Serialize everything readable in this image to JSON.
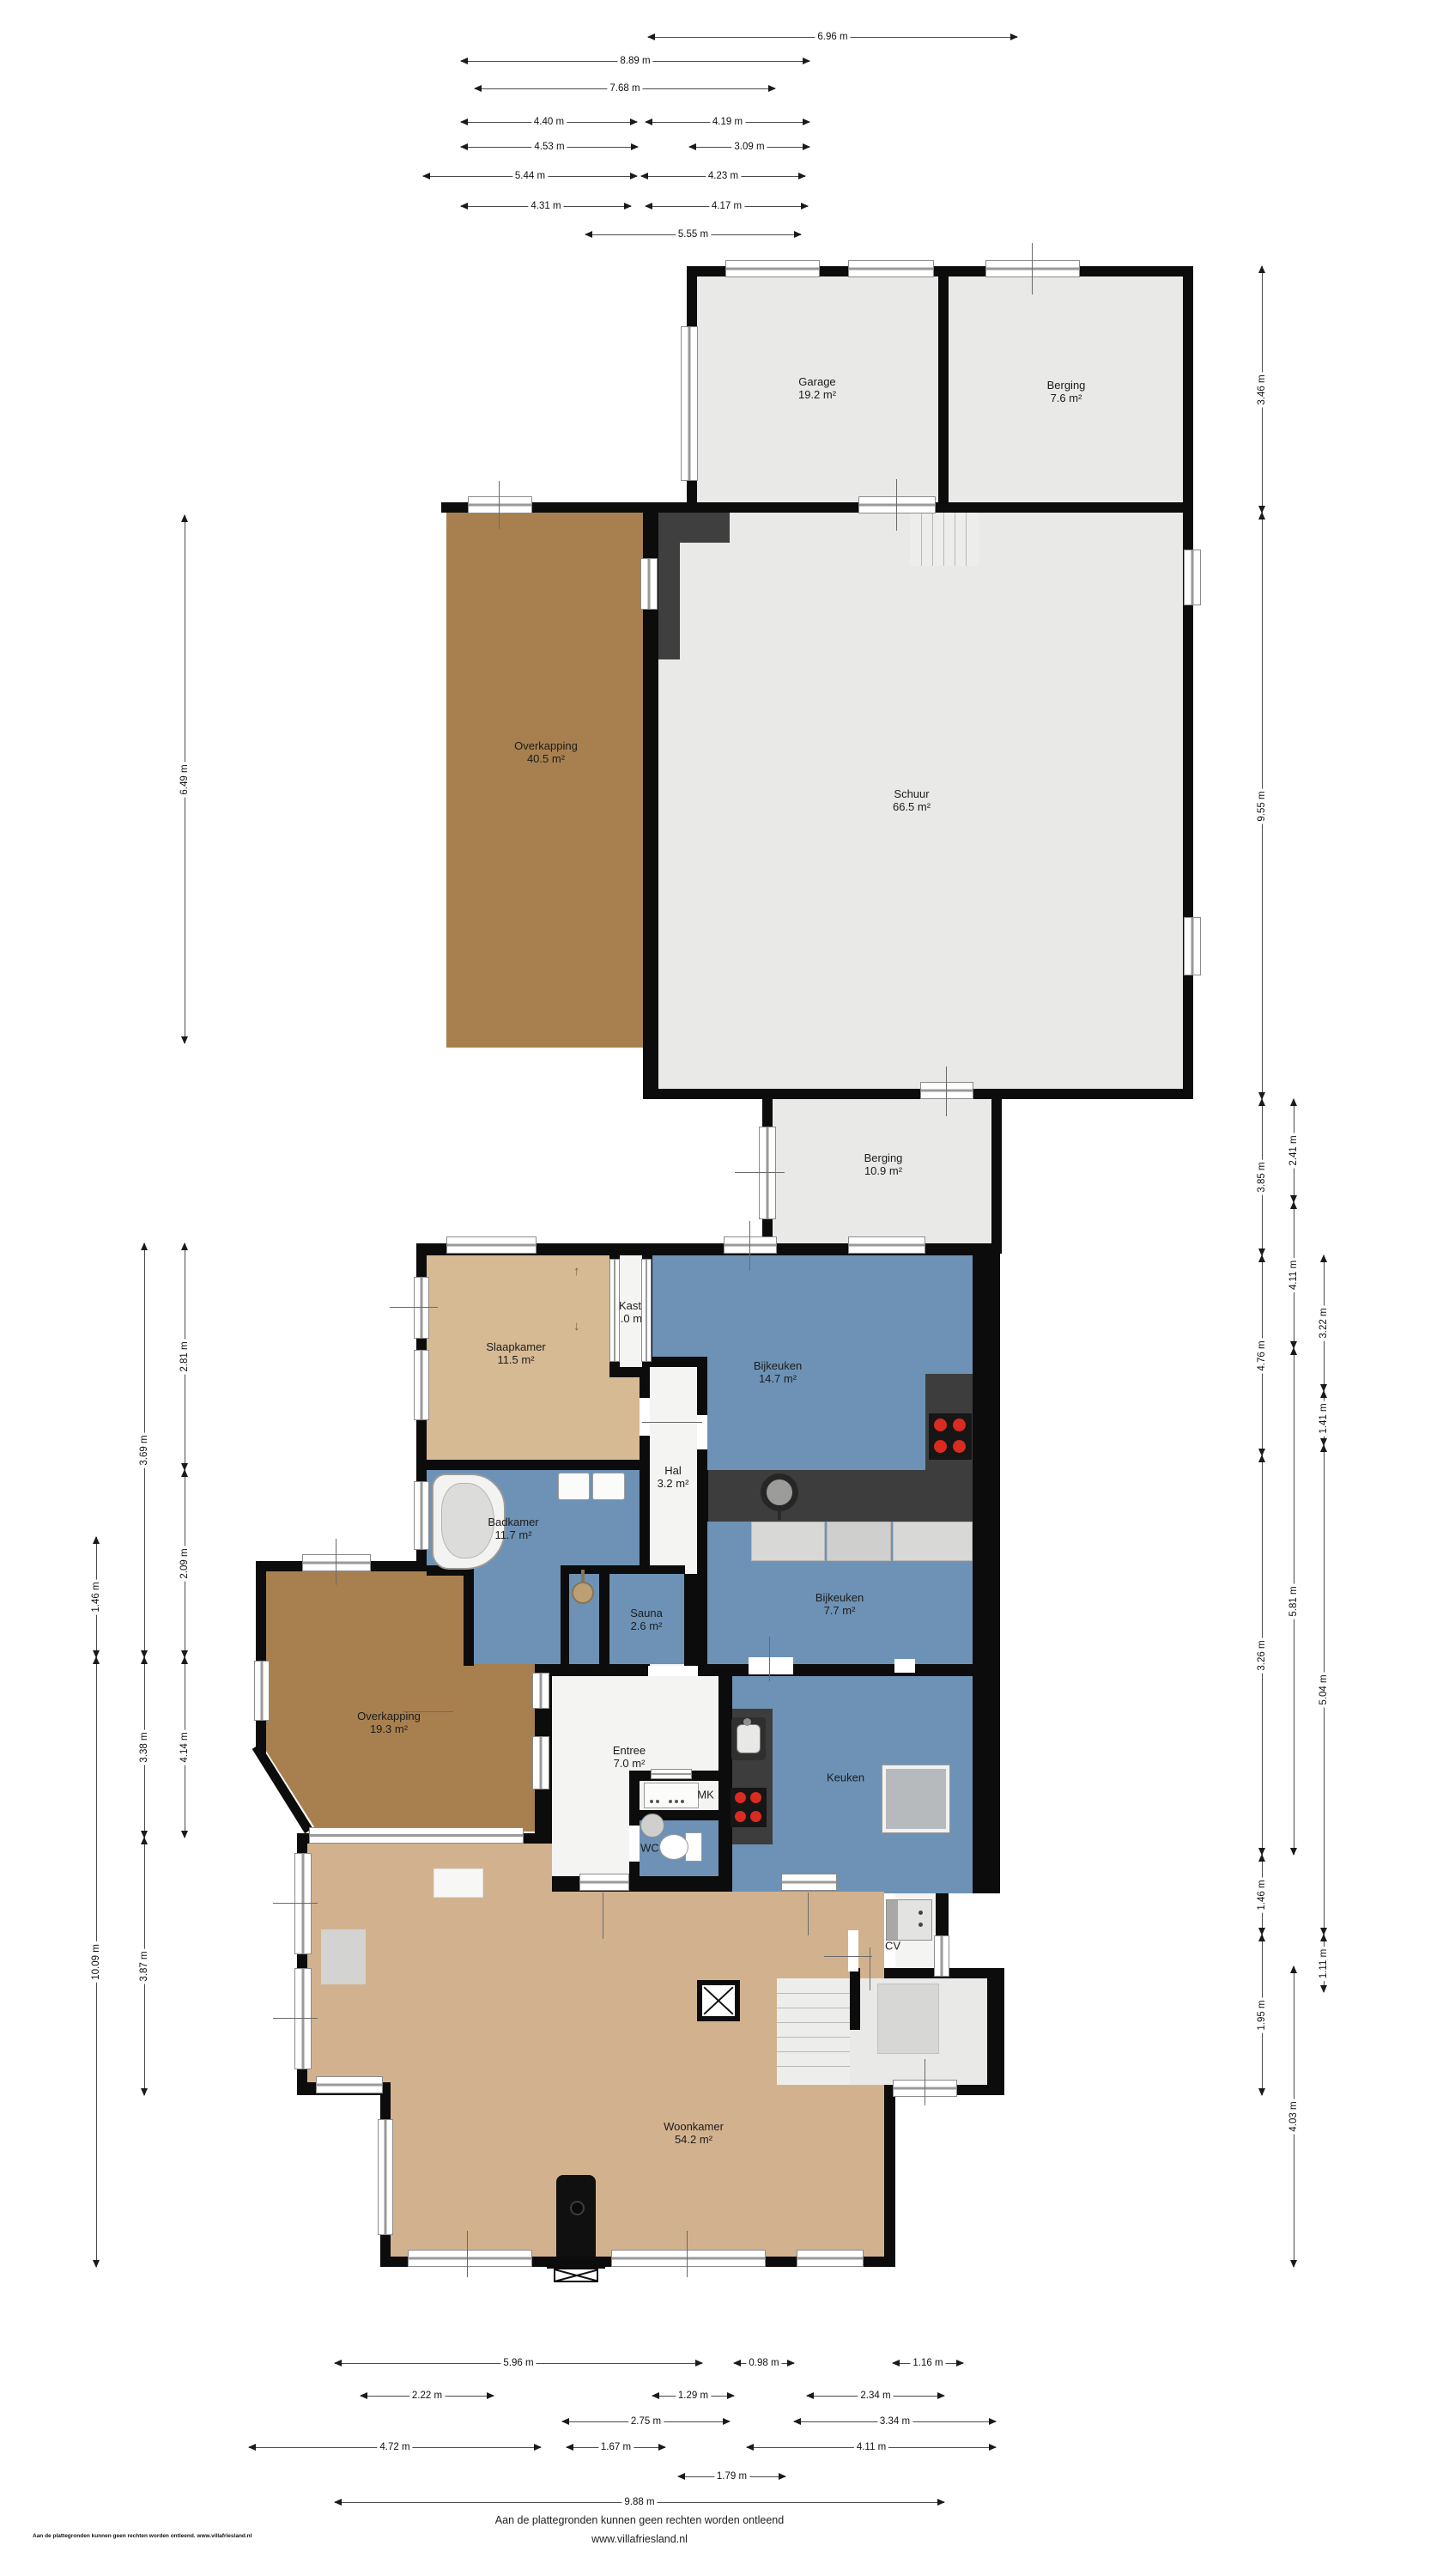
{
  "rooms": {
    "garage": {
      "name": "Garage",
      "area": "19.2 m²"
    },
    "berging_boven": {
      "name": "Berging",
      "area": "7.6 m²"
    },
    "overkapping_schuur": {
      "name": "Overkapping",
      "area": "40.5 m²"
    },
    "schuur": {
      "name": "Schuur",
      "area": "66.5 m²"
    },
    "berging_midden": {
      "name": "Berging",
      "area": "10.9 m²"
    },
    "slaapkamer": {
      "name": "Slaapkamer",
      "area": "11.5 m²"
    },
    "kast": {
      "name": "Kast",
      "area": "1.0 m²"
    },
    "bijkeuken_groot": {
      "name": "Bijkeuken",
      "area": "14.7 m²"
    },
    "hal": {
      "name": "Hal",
      "area": "3.2 m²"
    },
    "badkamer": {
      "name": "Badkamer",
      "area": "11.7 m²"
    },
    "sauna": {
      "name": "Sauna",
      "area": "2.6 m²"
    },
    "bijkeuken_klein": {
      "name": "Bijkeuken",
      "area": "7.7 m²"
    },
    "overkapping_woning": {
      "name": "Overkapping",
      "area": "19.3 m²"
    },
    "entree": {
      "name": "Entree",
      "area": "7.0 m²"
    },
    "meterkast": {
      "name": "MK"
    },
    "wc": {
      "name": "WC"
    },
    "keuken": {
      "name": "Keuken"
    },
    "cv": {
      "name": "CV"
    },
    "woonkamer": {
      "name": "Woonkamer",
      "area": "54.2 m²"
    }
  },
  "dimensions": {
    "top": [
      {
        "label": "6.96 m",
        "from": 755,
        "to": 1185,
        "at": 43
      },
      {
        "label": "8.89 m",
        "from": 537,
        "to": 943,
        "at": 71
      },
      {
        "label": "7.68 m",
        "from": 553,
        "to": 903,
        "at": 103
      },
      {
        "label": "4.40 m",
        "from": 537,
        "to": 742,
        "at": 142
      },
      {
        "label": "4.19 m",
        "from": 752,
        "to": 943,
        "at": 142
      },
      {
        "label": "4.53 m",
        "from": 537,
        "to": 743,
        "at": 171
      },
      {
        "label": "3.09 m",
        "from": 803,
        "to": 943,
        "at": 171
      },
      {
        "label": "5.44 m",
        "from": 493,
        "to": 742,
        "at": 205
      },
      {
        "label": "4.23 m",
        "from": 747,
        "to": 938,
        "at": 205
      },
      {
        "label": "4.31 m",
        "from": 537,
        "to": 735,
        "at": 240
      },
      {
        "label": "4.17 m",
        "from": 752,
        "to": 941,
        "at": 240
      },
      {
        "label": "5.55 m",
        "from": 682,
        "to": 933,
        "at": 273
      }
    ],
    "bottom": [
      {
        "label": "5.96 m",
        "from": 390,
        "to": 818,
        "at": 2752
      },
      {
        "label": "0.98 m",
        "from": 855,
        "to": 925,
        "at": 2752
      },
      {
        "label": "1.16 m",
        "from": 1040,
        "to": 1122,
        "at": 2752
      },
      {
        "label": "2.22 m",
        "from": 420,
        "to": 575,
        "at": 2790
      },
      {
        "label": "1.29 m",
        "from": 760,
        "to": 855,
        "at": 2790
      },
      {
        "label": "2.34 m",
        "from": 940,
        "to": 1100,
        "at": 2790
      },
      {
        "label": "2.75 m",
        "from": 655,
        "to": 850,
        "at": 2820
      },
      {
        "label": "3.34 m",
        "from": 925,
        "to": 1160,
        "at": 2820
      },
      {
        "label": "4.72 m",
        "from": 290,
        "to": 630,
        "at": 2850
      },
      {
        "label": "1.67 m",
        "from": 660,
        "to": 775,
        "at": 2850
      },
      {
        "label": "4.11 m",
        "from": 870,
        "to": 1160,
        "at": 2850
      },
      {
        "label": "1.79 m",
        "from": 790,
        "to": 915,
        "at": 2884
      },
      {
        "label": "9.88 m",
        "from": 390,
        "to": 1100,
        "at": 2914
      }
    ],
    "left": [
      {
        "label": "6.49 m",
        "from": 600,
        "to": 1215,
        "at": 215
      },
      {
        "label": "2.81 m",
        "from": 1448,
        "to": 1712,
        "at": 215
      },
      {
        "label": "2.09 m",
        "from": 1712,
        "to": 1930,
        "at": 215
      },
      {
        "label": "4.14 m",
        "from": 1930,
        "to": 2140,
        "at": 215
      },
      {
        "label": "3.69 m",
        "from": 1448,
        "to": 1930,
        "at": 168
      },
      {
        "label": "3.38 m",
        "from": 1930,
        "to": 2140,
        "at": 168
      },
      {
        "label": "3.87 m",
        "from": 2140,
        "to": 2440,
        "at": 168
      },
      {
        "label": "1.46 m",
        "from": 1790,
        "to": 1930,
        "at": 112
      },
      {
        "label": "10.09 m",
        "from": 1930,
        "to": 2640,
        "at": 112
      }
    ],
    "right": [
      {
        "label": "3.46 m",
        "from": 310,
        "to": 597,
        "at": 1470
      },
      {
        "label": "9.55 m",
        "from": 597,
        "to": 1280,
        "at": 1470
      },
      {
        "label": "3.85 m",
        "from": 1280,
        "to": 1462,
        "at": 1470
      },
      {
        "label": "4.76 m",
        "from": 1462,
        "to": 1695,
        "at": 1470
      },
      {
        "label": "3.26 m",
        "from": 1695,
        "to": 2160,
        "at": 1470
      },
      {
        "label": "1.46 m",
        "from": 2160,
        "to": 2253,
        "at": 1470
      },
      {
        "label": "1.95 m",
        "from": 2253,
        "to": 2440,
        "at": 1470
      },
      {
        "label": "2.41 m",
        "from": 1280,
        "to": 1400,
        "at": 1507
      },
      {
        "label": "4.11 m",
        "from": 1400,
        "to": 1570,
        "at": 1507
      },
      {
        "label": "5.81 m",
        "from": 1570,
        "to": 2160,
        "at": 1507
      },
      {
        "label": "4.03 m",
        "from": 2290,
        "to": 2640,
        "at": 1507
      },
      {
        "label": "3.22 m",
        "from": 1462,
        "to": 1620,
        "at": 1542
      },
      {
        "label": "1.41 m",
        "from": 1620,
        "to": 1683,
        "at": 1542
      },
      {
        "label": "5.04 m",
        "from": 1683,
        "to": 2253,
        "at": 1542
      },
      {
        "label": "1.11 m",
        "from": 2253,
        "to": 2320,
        "at": 1542
      }
    ]
  },
  "footer": {
    "line1": "Aan de plattegronden kunnen geen rechten worden ontleend",
    "line2": "www.villafriesland.nl",
    "watermark": "Aan de plattegronden kunnen geen rechten worden ontleend. www.villafriesland.nl"
  },
  "colors": {
    "wall": "#0c0c0c",
    "room_gray": "#e9e9e8",
    "blue": "#6d92b5",
    "tan": "#d2b28e",
    "tan_light": "#d6ba94",
    "brown": "#a8804f",
    "counter": "#3d3d3d",
    "burner": "#d92b1f"
  }
}
